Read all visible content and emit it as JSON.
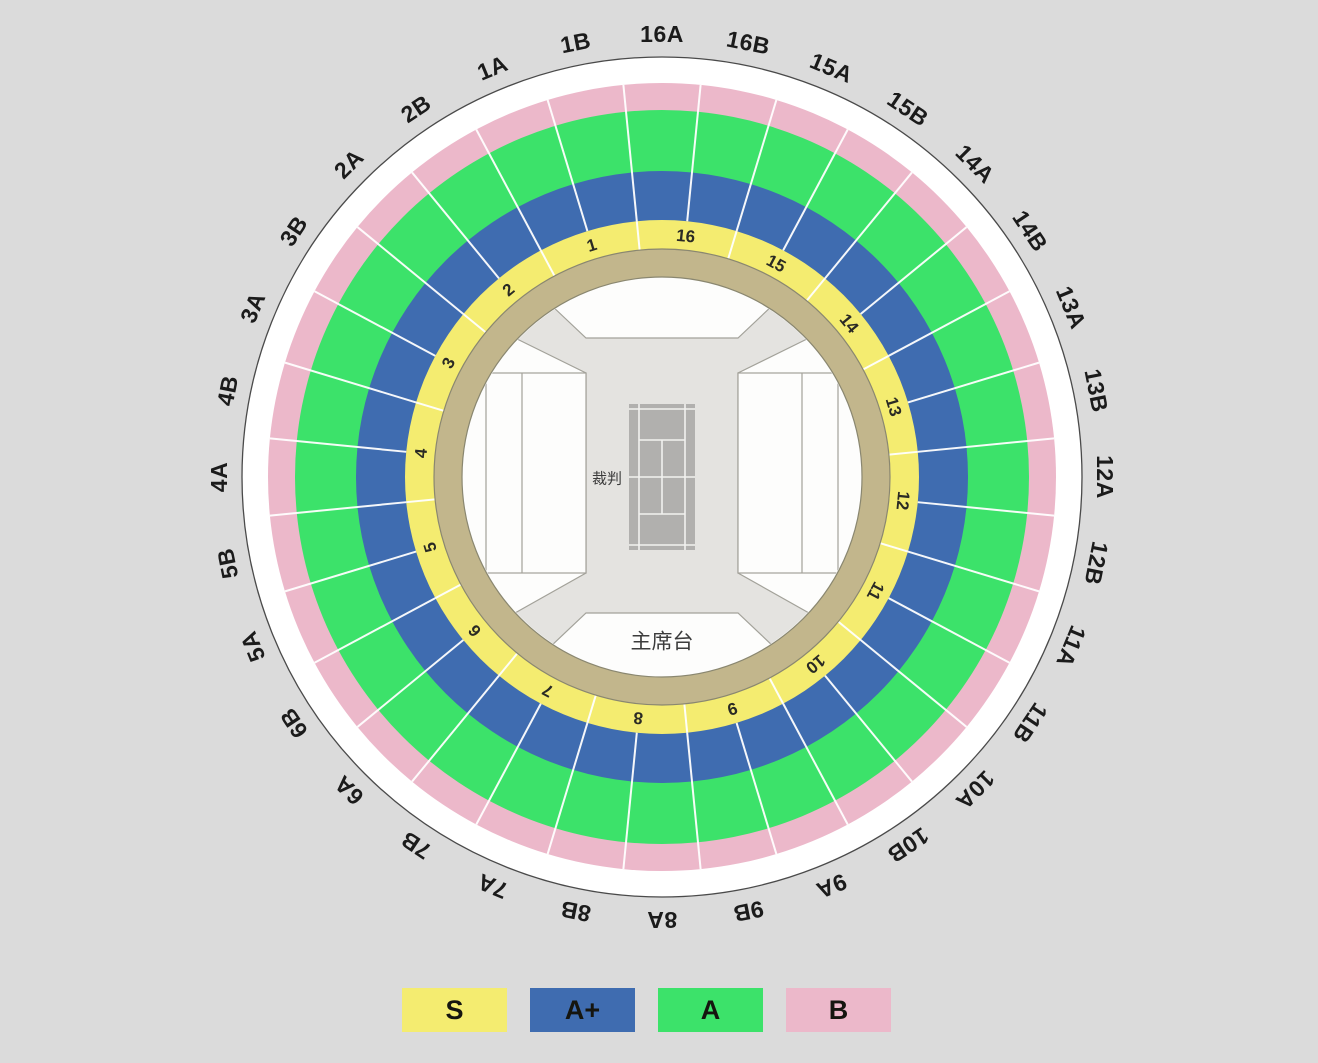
{
  "page": {
    "background": "#dbdbdb"
  },
  "stadium": {
    "outer_labels_clockwise_from_top": [
      "16A",
      "16B",
      "15A",
      "15B",
      "14A",
      "14B",
      "13A",
      "13B",
      "12A",
      "12B",
      "11A",
      "11B",
      "10A",
      "10B",
      "9A",
      "9B",
      "8A",
      "8B",
      "7A",
      "7B",
      "6A",
      "6B",
      "5A",
      "5B",
      "4A",
      "4B",
      "3A",
      "3B",
      "2A",
      "2B",
      "1A",
      "1B"
    ],
    "inner_section_numbers": [
      "1",
      "2",
      "3",
      "4",
      "5",
      "6",
      "7",
      "8",
      "9",
      "10",
      "11",
      "12",
      "13",
      "14",
      "15",
      "16"
    ],
    "center_labels": {
      "referee": "裁判",
      "rostrum": "主席台"
    },
    "tiers": {
      "S": {
        "label": "S",
        "color": "#f4ec70"
      },
      "Aplus": {
        "label": "A+",
        "color": "#3f6cb0"
      },
      "A": {
        "label": "A",
        "color": "#3ce26a"
      },
      "B": {
        "label": "B",
        "color": "#ecb8ca"
      }
    },
    "walkway_color": "#c2b68c",
    "outer_ring_color": "#ffffff",
    "bowl_colors": {
      "floor": "#fdfdfc",
      "corridor": "#e4e3e0",
      "court": "#b1b0ae"
    }
  },
  "legend": {
    "items": [
      {
        "label": "S",
        "color": "#f4ec70"
      },
      {
        "label": "A+",
        "color": "#3f6cb0"
      },
      {
        "label": "A",
        "color": "#3ce26a"
      },
      {
        "label": "B",
        "color": "#ecb8ca"
      }
    ]
  }
}
